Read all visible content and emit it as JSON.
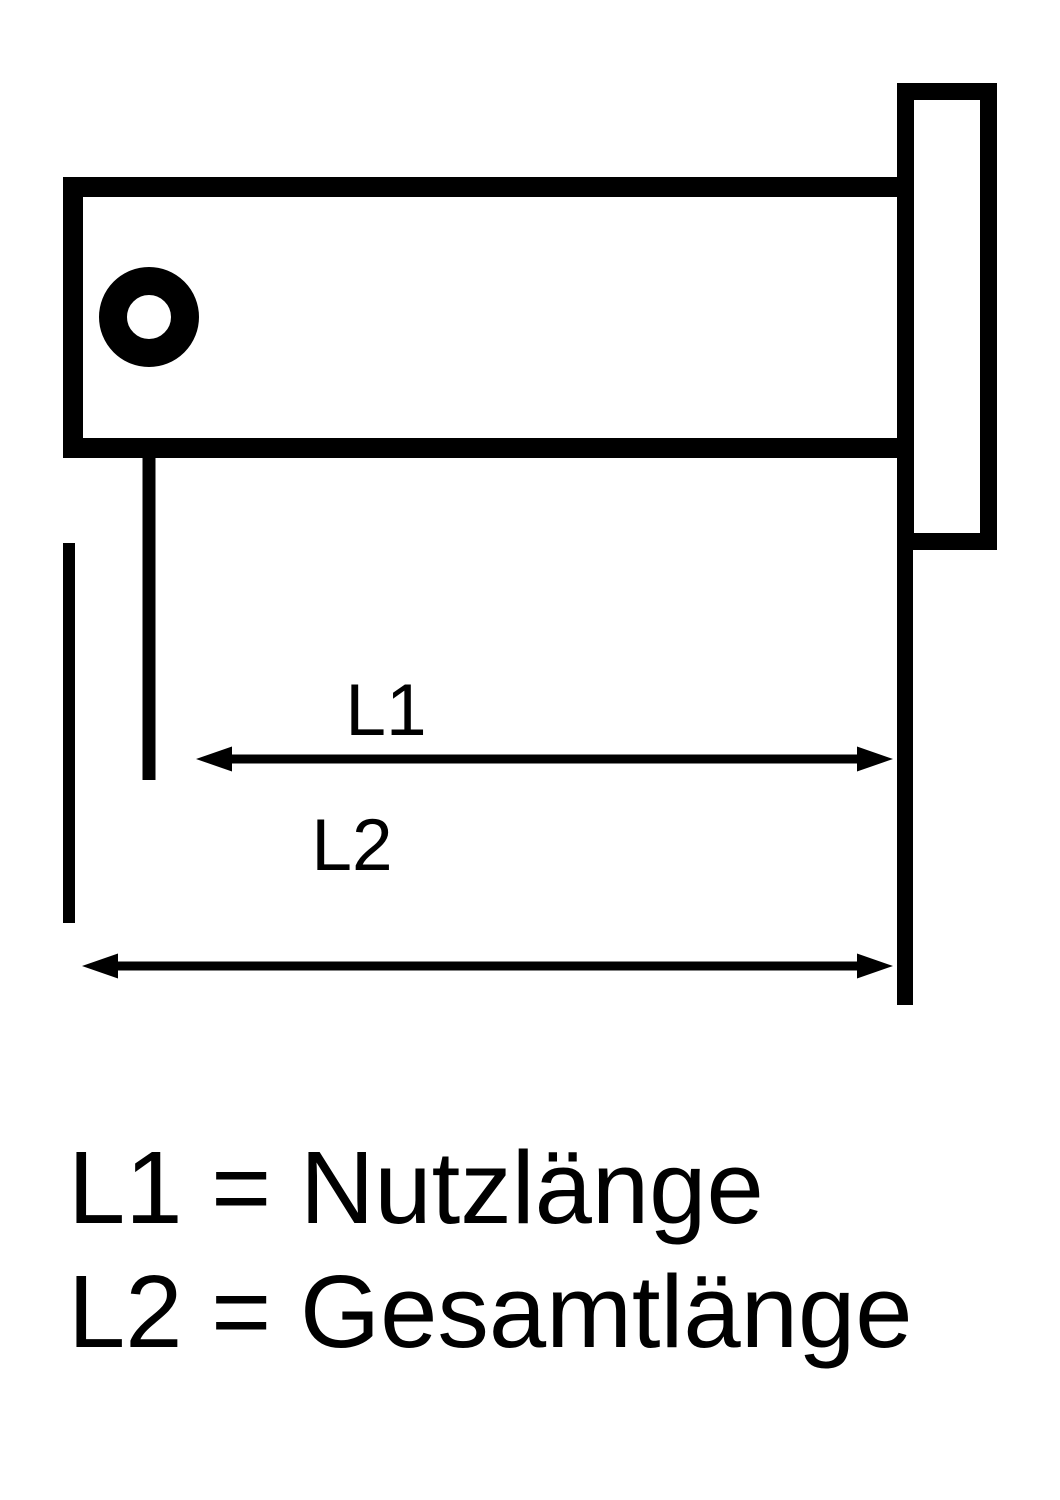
{
  "diagram": {
    "kind": "technical-dimension-drawing",
    "subject": "clevis-pin-with-head-and-split-pin-hole",
    "colors": {
      "line": "#000000",
      "background": "#ffffff"
    },
    "dimensions": {
      "l1_label": "L1",
      "l2_label": "L2"
    },
    "legend": {
      "line1": "L1 = Nutzlänge",
      "line2": "L2 = Gesamtlänge"
    }
  }
}
